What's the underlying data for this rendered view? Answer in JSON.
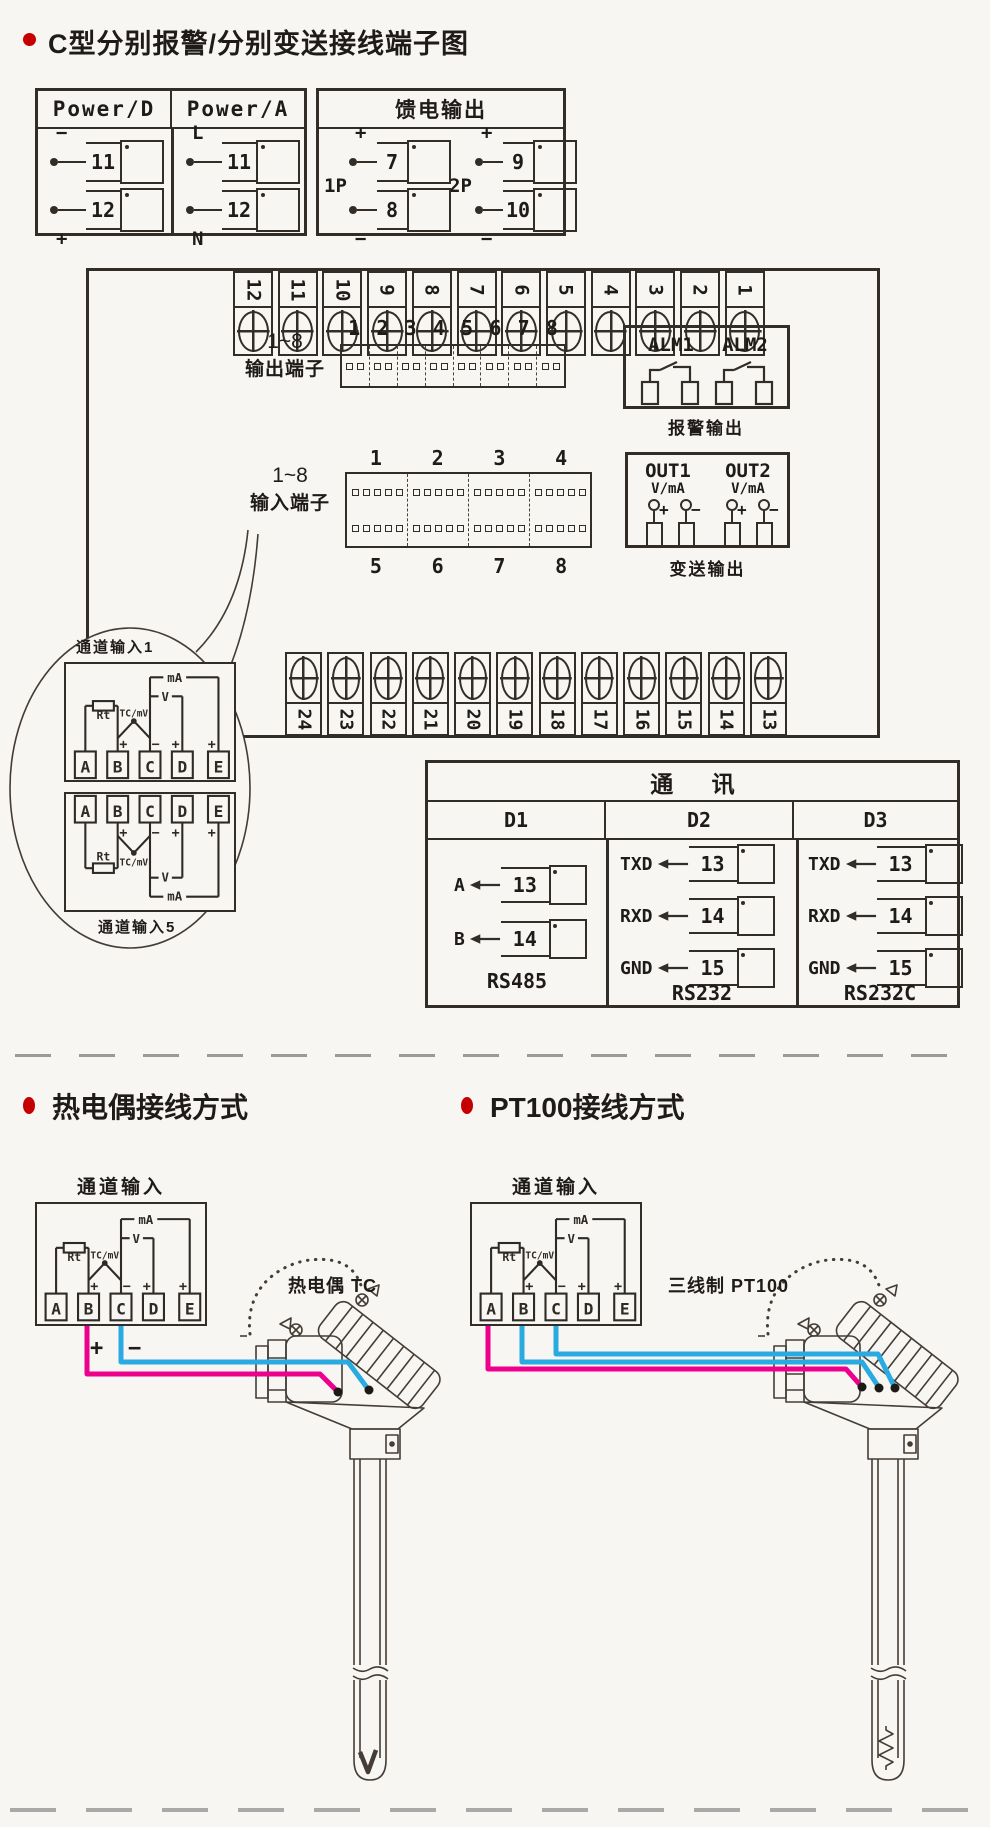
{
  "page": {
    "title": "C型分别报警/分别变送接线端子图"
  },
  "power_box": {
    "headers": [
      "Power/D",
      "Power/A"
    ],
    "d_rows": [
      {
        "sign": "−",
        "num": "11"
      },
      {
        "sign": "+",
        "num": "12"
      }
    ],
    "a_rows": [
      {
        "sign": "L",
        "num": "11"
      },
      {
        "sign": "N",
        "num": "12"
      }
    ]
  },
  "feed_box": {
    "header": "馈电输出",
    "groups": [
      {
        "label": "1P",
        "rows": [
          {
            "sign": "+",
            "num": "7"
          },
          {
            "sign": "−",
            "num": "8"
          }
        ]
      },
      {
        "label": "2P",
        "rows": [
          {
            "sign": "+",
            "num": "9"
          },
          {
            "sign": "−",
            "num": "10"
          }
        ]
      }
    ]
  },
  "board": {
    "top_terminals": [
      "12",
      "11",
      "10",
      "9",
      "8",
      "7",
      "6",
      "5",
      "4",
      "3",
      "2",
      "1"
    ],
    "bottom_terminals": [
      "24",
      "23",
      "22",
      "21",
      "20",
      "19",
      "18",
      "17",
      "16",
      "15",
      "14",
      "13"
    ],
    "output_label": [
      "1~8",
      "输出端子"
    ],
    "output_numbers": [
      "1",
      "2",
      "3",
      "4",
      "5",
      "6",
      "7",
      "8"
    ],
    "input_label": [
      "1~8",
      "输入端子"
    ],
    "input_numbers_top": [
      "1",
      "2",
      "3",
      "4"
    ],
    "input_numbers_bottom": [
      "5",
      "6",
      "7",
      "8"
    ],
    "alarm": {
      "labels": [
        "ALM1",
        "ALM2"
      ],
      "caption": "报警输出"
    },
    "transmit": {
      "labels": [
        "OUT1",
        "OUT2"
      ],
      "unit": "V/mA",
      "signs": [
        "+",
        "−",
        "+",
        "−"
      ],
      "caption": "变送输出"
    }
  },
  "balloon": {
    "top_label": "通道输入1",
    "bottom_label": "通道输入5"
  },
  "channel": {
    "terminals": [
      "A",
      "B",
      "C",
      "D",
      "E"
    ],
    "rt": "Rt",
    "tc": "TC/mV",
    "v": "V",
    "ma": "mA",
    "plus": "+",
    "minus": "−"
  },
  "comm": {
    "title": "通 讯",
    "columns": [
      {
        "header": "D1",
        "rows": [
          {
            "label": "A",
            "num": "13"
          },
          {
            "label": "B",
            "num": "14"
          }
        ],
        "caption": "RS485"
      },
      {
        "header": "D2",
        "rows": [
          {
            "label": "TXD",
            "num": "13"
          },
          {
            "label": "RXD",
            "num": "14"
          },
          {
            "label": "GND",
            "num": "15"
          }
        ],
        "caption": "RS232"
      },
      {
        "header": "D3",
        "rows": [
          {
            "label": "TXD",
            "num": "13"
          },
          {
            "label": "RXD",
            "num": "14"
          },
          {
            "label": "GND",
            "num": "15"
          }
        ],
        "caption": "RS232C"
      }
    ]
  },
  "tc_section": {
    "heading": "热电偶接线方式",
    "channel_label": "通道输入",
    "probe_label": "热电偶 TC",
    "plus": "+",
    "minus": "−"
  },
  "pt_section": {
    "heading": "PT100接线方式",
    "channel_label": "通道输入",
    "probe_label": "三线制 PT100"
  },
  "colors": {
    "accent_red": "#c40000",
    "wire_pink": "#ec008c",
    "wire_blue": "#29abe2",
    "ink": "#332d28"
  }
}
